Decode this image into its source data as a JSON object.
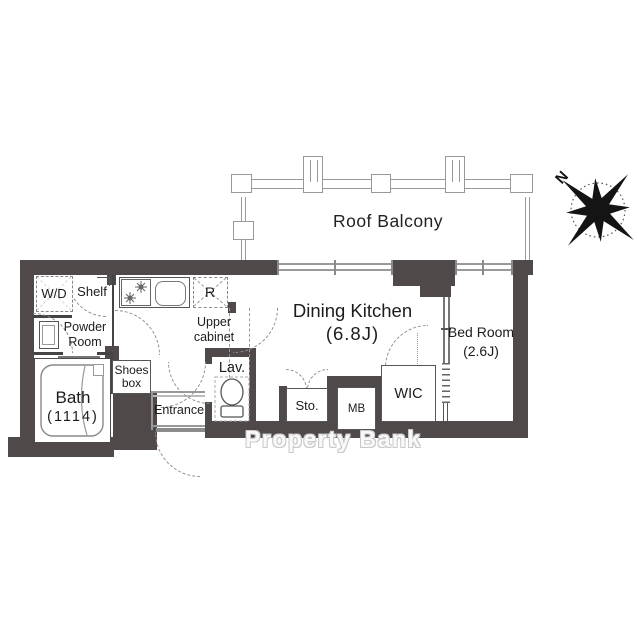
{
  "floor_plan": {
    "balcony": {
      "label": "Roof Balcony"
    },
    "compass": {
      "north": "N"
    },
    "rooms": {
      "dining_kitchen": {
        "name": "Dining Kitchen",
        "size": "(6.8J)"
      },
      "bed_room": {
        "name": "Bed Room",
        "size": "(2.6J)"
      },
      "bath": {
        "name": "Bath",
        "size": "(1114)"
      },
      "powder_room": {
        "line1": "Powder",
        "line2": "Room"
      },
      "entrance": {
        "name": "Entrance"
      },
      "lavatory": {
        "name": "Lav."
      },
      "storage": {
        "name": "Sto."
      },
      "meter_box": {
        "name": "MB"
      },
      "walk_in_closet": {
        "name": "WIC"
      }
    },
    "fixtures": {
      "washer_dryer": {
        "name": "W/D"
      },
      "shelf": {
        "name": "Shelf"
      },
      "refrigerator": {
        "name": "R"
      },
      "upper_cabinet": {
        "line1": "Upper",
        "line2": "cabinet"
      },
      "shoes_box": {
        "line1": "Shoes",
        "line2": "box"
      }
    },
    "watermark": {
      "text": "Property Bank"
    },
    "colors": {
      "wall": "#4f4949",
      "line": "#555555",
      "balcony_line": "#999999",
      "text": "#1c1c1c"
    }
  }
}
